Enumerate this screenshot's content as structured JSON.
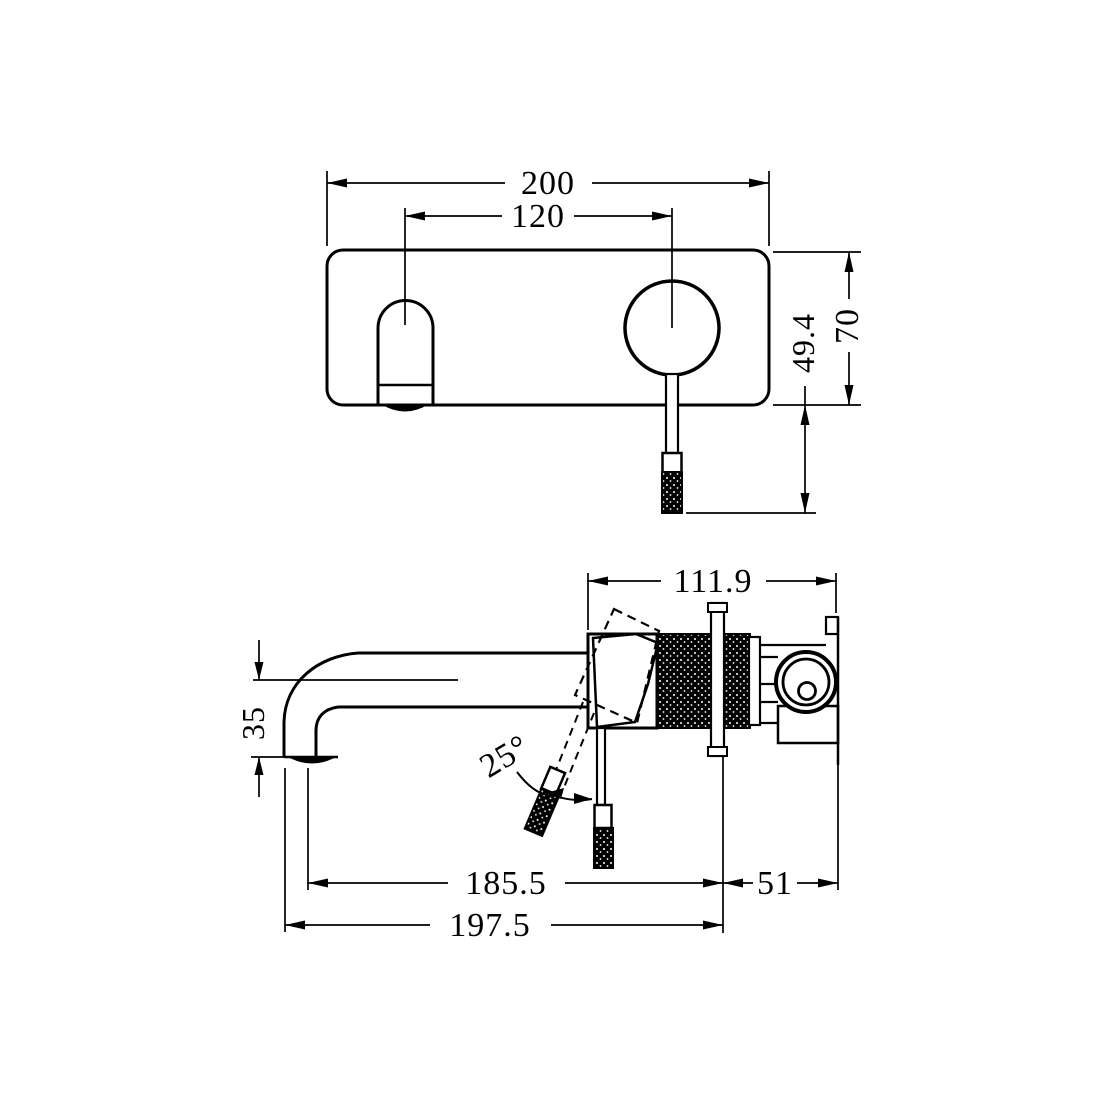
{
  "drawing": {
    "type": "technical-dimension-drawing",
    "subject": "wall-mounted basin mixer tap, front and side views",
    "front_view": {
      "overall_width": "200",
      "hole_spacing": "120",
      "handle_drop": "49.4",
      "plate_height": "70"
    },
    "side_view": {
      "body_depth": "111.9",
      "spout_drop": "35",
      "handle_angle": "25°",
      "spout_reach": "185.5",
      "rear_depth": "51",
      "overall_reach": "197.5"
    },
    "colors": {
      "line": "#000000",
      "background": "#ffffff"
    }
  }
}
